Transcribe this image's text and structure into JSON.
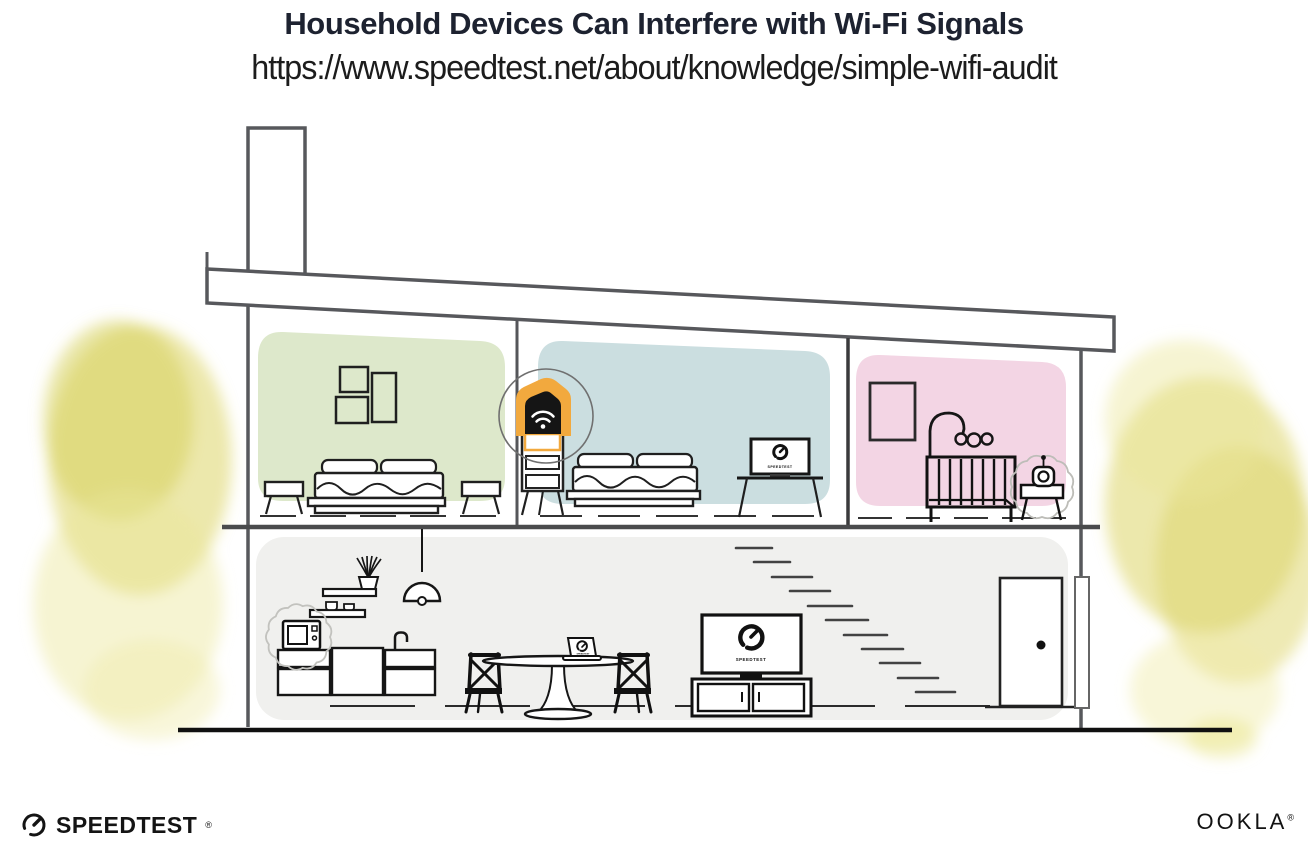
{
  "header": {
    "title": "Household Devices Can Interfere with Wi-Fi Signals",
    "url": "https://www.speedtest.net/about/knowledge/simple-wifi-audit"
  },
  "branding": {
    "speedtest": {
      "label": "SPEEDTEST",
      "mark": "®"
    },
    "ookla": {
      "label": "OOKLA",
      "mark": "®"
    }
  },
  "screens": {
    "bedroom_monitor_label": "SPEEDTEST",
    "living_room_tv_label": "SPEEDTEST",
    "laptop_label": "SPEEDTEST"
  },
  "colors": {
    "accent_orange": "#F2A93E",
    "room_green": "#DDE8CB",
    "room_blue": "#CBDEE0",
    "room_pink": "#F3D5E4",
    "downstairs_gray": "#F0F0EE",
    "foliage_yellow": "#DCD566",
    "foliage_yellow_light": "#ECE79C",
    "structure_gray": "#58595B",
    "line_ink": "#1A1A1A",
    "title_ink": "#1D2230"
  }
}
